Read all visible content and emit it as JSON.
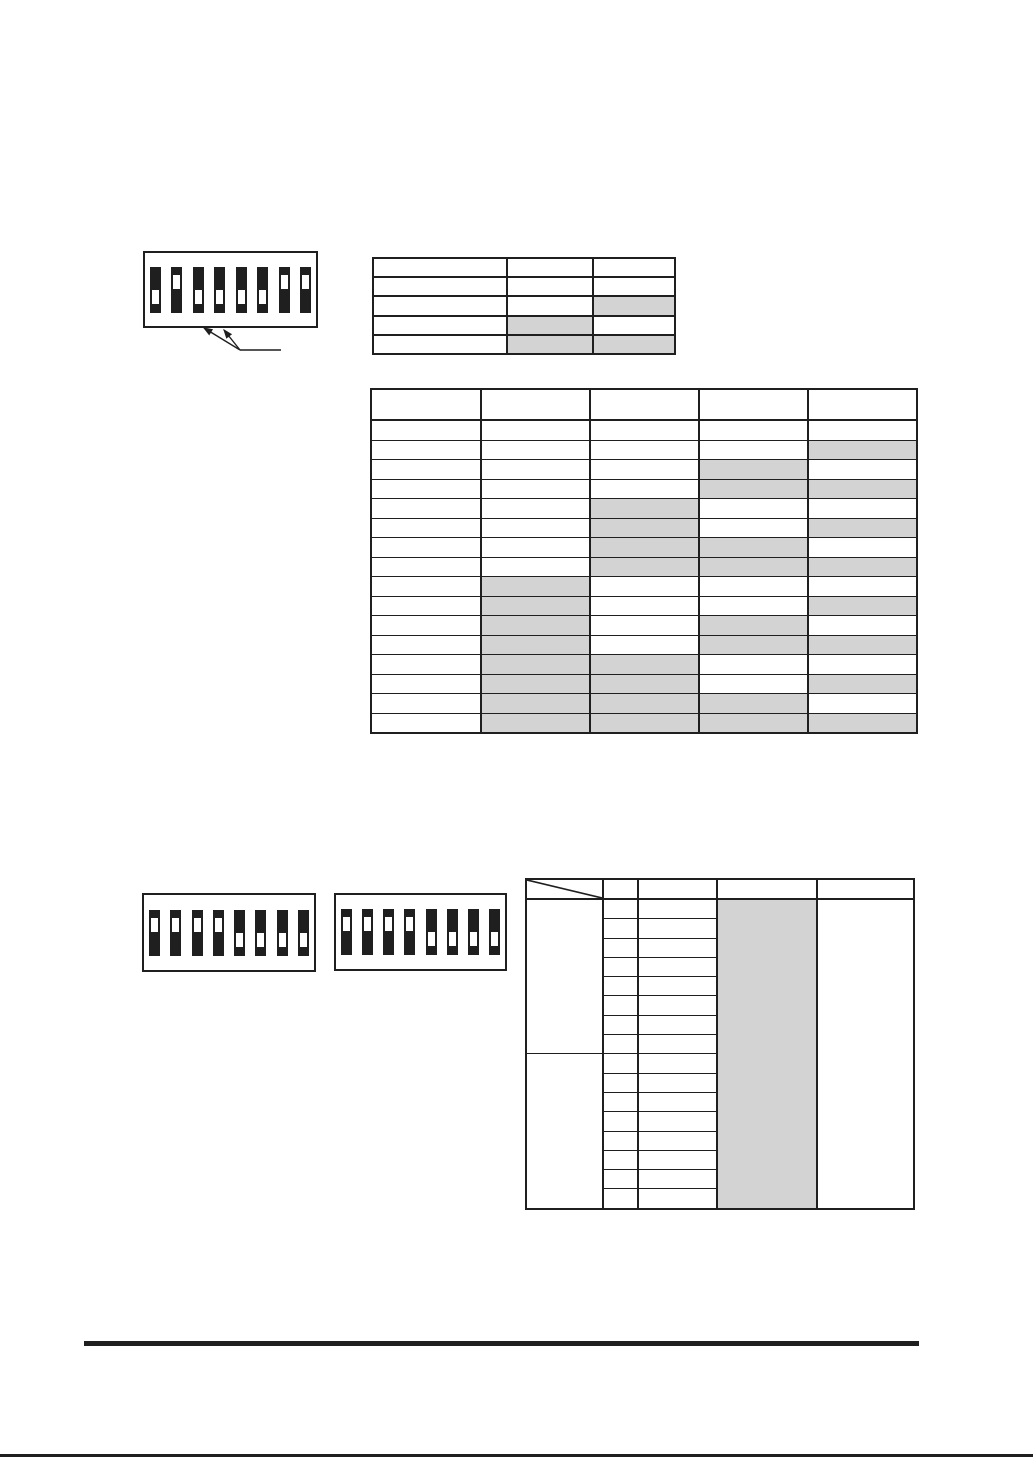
{
  "document": {
    "kind": "scanned-manual-page-dip-switch-settings",
    "background": "#ffffff",
    "line_color": "#1f1f1f",
    "shade_color": "#d3d3d3",
    "text_content": ""
  },
  "dip_blocks": [
    {
      "id": "top",
      "switch_count": 8,
      "states": [
        "down",
        "up",
        "down",
        "down",
        "down",
        "down",
        "up",
        "up"
      ]
    },
    {
      "id": "bottom-a",
      "switch_count": 8,
      "states": [
        "up",
        "up",
        "up",
        "up",
        "down",
        "down",
        "down",
        "down"
      ]
    },
    {
      "id": "bottom-b",
      "switch_count": 8,
      "states": [
        "up",
        "up",
        "up",
        "up",
        "down",
        "down",
        "down",
        "down"
      ]
    }
  ],
  "callout": {
    "arrow_count": 2,
    "points_to": "switches 3 and 4 of top dip block",
    "label_text": ""
  },
  "tables": {
    "switch_legend": {
      "position": "top-right",
      "columns": 3,
      "rows": 5,
      "header_rows": 1,
      "shaded_cells_row_col": [
        [
          2,
          2
        ],
        [
          3,
          1
        ],
        [
          4,
          1
        ],
        [
          4,
          2
        ]
      ]
    },
    "binary_combinations": {
      "position": "middle",
      "columns": 5,
      "data_rows": 16,
      "header_rows": 1,
      "shaded_cols_by_row": [
        [],
        [
          4
        ],
        [
          3
        ],
        [
          3,
          4
        ],
        [
          2
        ],
        [
          2,
          4
        ],
        [
          2,
          3
        ],
        [
          2,
          3,
          4
        ],
        [
          1
        ],
        [
          1,
          4
        ],
        [
          1,
          3
        ],
        [
          1,
          3,
          4
        ],
        [
          1,
          2
        ],
        [
          1,
          2,
          4
        ],
        [
          1,
          2,
          3
        ],
        [
          1,
          2,
          3,
          4
        ]
      ]
    },
    "address_matrix": {
      "position": "bottom-right",
      "columns": 5,
      "data_rows": 16,
      "header_rows": 1,
      "header_diagonal_cell_index": 0,
      "first_column_row_groups": [
        8,
        8
      ],
      "shaded_full_column_index": 3,
      "last_column_merged": true
    }
  },
  "footer": {
    "has_rule": true,
    "has_bottom_edge_line": true,
    "text": ""
  }
}
